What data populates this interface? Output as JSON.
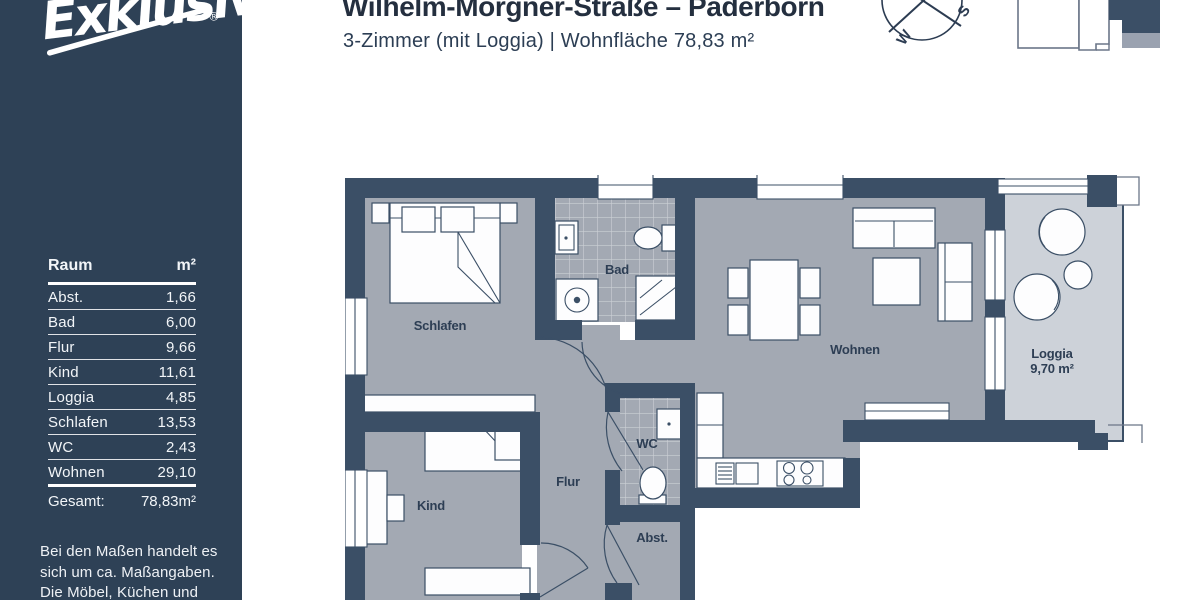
{
  "logo": {
    "text": "Exklusiv",
    "reg": "®"
  },
  "header": {
    "title": "Wilhelm-Morgner-Straße – Paderborn",
    "subtitle": "3-Zimmer (mit Loggia) | Wohnfläche 78,83 m²"
  },
  "sidebar": {
    "table": {
      "col_room": "Raum",
      "col_area": "m²",
      "rows": [
        {
          "room": "Abst.",
          "area": "1,66"
        },
        {
          "room": "Bad",
          "area": "6,00"
        },
        {
          "room": "Flur",
          "area": "9,66"
        },
        {
          "room": "Kind",
          "area": "11,61"
        },
        {
          "room": "Loggia",
          "area": "4,85"
        },
        {
          "room": "Schlafen",
          "area": "13,53"
        },
        {
          "room": "WC",
          "area": "2,43"
        },
        {
          "room": "Wohnen",
          "area": "29,10"
        }
      ],
      "total_label": "Gesamt:",
      "total_value": "78,83m²"
    },
    "disclaimer_lines": [
      "Bei den Maßen handelt es",
      "sich um ca. Maßangaben.",
      "Die Möbel, Küchen und",
      "Sanitärobjekte sind"
    ]
  },
  "compass": {
    "s": "S",
    "w": "W"
  },
  "floorplan": {
    "labels": {
      "schlafen": "Schlafen",
      "bad": "Bad",
      "wohnen": "Wohnen",
      "loggia": "Loggia",
      "loggia_area": "9,70 m²",
      "kind": "Kind",
      "flur": "Flur",
      "wc": "WC",
      "abst": "Abst."
    }
  },
  "colors": {
    "sidebar": "#2e4156",
    "wall": "#3b4f66",
    "floor": "#a3a9b3",
    "loggia_floor": "#cdd2d9",
    "text_dark": "#242f3f"
  }
}
